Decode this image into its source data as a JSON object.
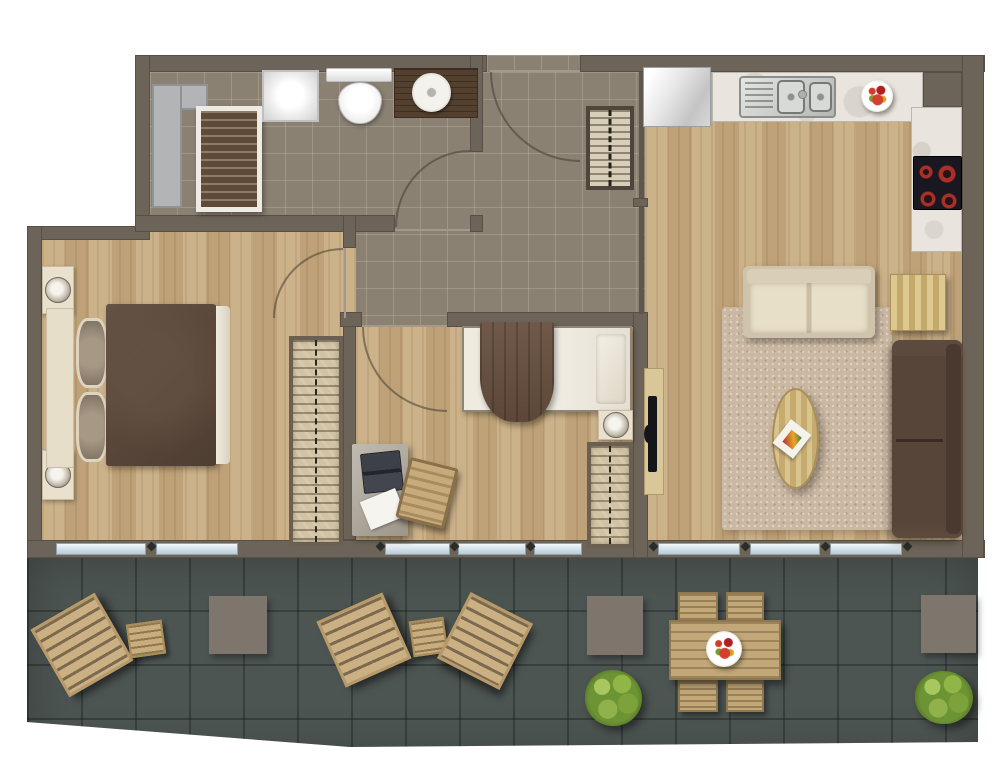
{
  "plan_type": "apartment-floor-plan-top-view",
  "rooms": [
    {
      "name": "bathroom",
      "floor": "grey-tile"
    },
    {
      "name": "entry-hall",
      "floor": "grey-tile"
    },
    {
      "name": "master-bedroom",
      "floor": "light-wood"
    },
    {
      "name": "bedroom-2",
      "floor": "light-wood"
    },
    {
      "name": "kitchen-living-room",
      "floor": "light-wood"
    },
    {
      "name": "terrace",
      "floor": "dark-slate-tile"
    }
  ],
  "palette": {
    "wall": "#6d6459",
    "hall_tile": "#8a8173",
    "wood_floor": "#c6aa80",
    "terrace_tile": "#4d5553",
    "rug": "#cbb8a2",
    "glass": "#d8e8f1",
    "sofa_cream": "#d9cfb8",
    "sofa_brown": "#57453a",
    "burner_red": "#a83028",
    "plant_green": "#6d9434"
  },
  "items": [
    {
      "kind": "duct",
      "name": "service-duct-vertical",
      "x": 152,
      "y": 84,
      "w": 30,
      "h": 124
    },
    {
      "kind": "duct",
      "name": "service-duct-top",
      "x": 180,
      "y": 84,
      "w": 28,
      "h": 26
    },
    {
      "kind": "cab-slats",
      "name": "bathroom-slatted-cabinet",
      "x": 196,
      "y": 106,
      "w": 66,
      "h": 106
    },
    {
      "kind": "shower",
      "name": "shower-tray",
      "x": 262,
      "y": 70,
      "w": 57,
      "h": 52
    },
    {
      "kind": "toilet-tank",
      "name": "toilet-cistern",
      "x": 326,
      "y": 68,
      "w": 66,
      "h": 14
    },
    {
      "kind": "toilet-bowl",
      "name": "toilet-bowl",
      "x": 338,
      "y": 82,
      "w": 44,
      "h": 42
    },
    {
      "kind": "vanity",
      "name": "bathroom-vanity",
      "x": 394,
      "y": 68,
      "w": 84,
      "h": 50
    },
    {
      "kind": "sink-round",
      "name": "bathroom-basin",
      "x": 412,
      "y": 73,
      "w": 39,
      "h": 39
    },
    {
      "kind": "closet",
      "name": "entry-closet",
      "x": 586,
      "y": 106,
      "w": 48,
      "h": 84
    },
    {
      "kind": "fridge",
      "name": "refrigerator",
      "x": 643,
      "y": 67,
      "w": 68,
      "h": 60
    },
    {
      "kind": "counter",
      "name": "kitchen-counter-top",
      "x": 712,
      "y": 72,
      "w": 211,
      "h": 50
    },
    {
      "kind": "counter",
      "name": "kitchen-counter-right",
      "x": 911,
      "y": 107,
      "w": 51,
      "h": 145
    },
    {
      "kind": "sink",
      "name": "kitchen-sink-unit",
      "x": 739,
      "y": 76,
      "w": 97,
      "h": 42
    },
    {
      "kind": "sinkboard",
      "name": "sink-drainboard",
      "x": 745,
      "y": 82,
      "w": 28,
      "h": 30
    },
    {
      "kind": "sinkbowl",
      "name": "sink-bowl-large",
      "x": 777,
      "y": 80,
      "w": 28,
      "h": 34
    },
    {
      "kind": "sinkbowl",
      "name": "sink-bowl-small",
      "x": 809,
      "y": 82,
      "w": 23,
      "h": 30
    },
    {
      "kind": "faucet",
      "name": "kitchen-faucet",
      "x": 798,
      "y": 90,
      "w": 9,
      "h": 9
    },
    {
      "kind": "bowl",
      "name": "fruit-bowl-kitchen",
      "x": 861,
      "y": 80,
      "w": 32,
      "h": 32
    },
    {
      "kind": "cooktop",
      "name": "cooktop-4-burners",
      "x": 913,
      "y": 156,
      "w": 49,
      "h": 54
    },
    {
      "kind": "rug",
      "name": "living-room-rug",
      "x": 722,
      "y": 307,
      "w": 170,
      "h": 223
    },
    {
      "kind": "tv-unit",
      "name": "tv-stand",
      "x": 644,
      "y": 368,
      "w": 20,
      "h": 127
    },
    {
      "kind": "tv",
      "name": "television",
      "x": 648,
      "y": 396,
      "w": 9,
      "h": 76
    },
    {
      "kind": "sofa-cream",
      "name": "sofa-two-seater",
      "x": 743,
      "y": 266,
      "w": 132,
      "h": 72
    },
    {
      "kind": "ottoman",
      "name": "striped-ottoman",
      "x": 890,
      "y": 274,
      "w": 56,
      "h": 57
    },
    {
      "kind": "sofa-brown",
      "name": "sofa-brown-chaise",
      "x": 892,
      "y": 340,
      "w": 71,
      "h": 198
    },
    {
      "kind": "coffee",
      "name": "coffee-table-oval",
      "x": 772,
      "y": 388,
      "w": 47,
      "h": 101
    },
    {
      "kind": "magazine",
      "name": "magazine",
      "x": 779,
      "y": 424,
      "w": 26,
      "h": 30,
      "rot": 38
    },
    {
      "kind": "nightstand",
      "name": "nightstand-master-top",
      "x": 42,
      "y": 266,
      "w": 32,
      "h": 48
    },
    {
      "kind": "nightstand",
      "name": "nightstand-master-bottom",
      "x": 42,
      "y": 450,
      "w": 32,
      "h": 50
    },
    {
      "kind": "headboard",
      "name": "double-bed-headboard",
      "x": 46,
      "y": 308,
      "w": 28,
      "h": 160
    },
    {
      "kind": "pillow",
      "name": "pillow-top",
      "x": 76,
      "y": 318,
      "w": 32,
      "h": 70
    },
    {
      "kind": "pillow",
      "name": "pillow-bottom",
      "x": 76,
      "y": 392,
      "w": 32,
      "h": 70
    },
    {
      "kind": "duvet",
      "name": "double-bed-duvet",
      "x": 106,
      "y": 304,
      "w": 112,
      "h": 162
    },
    {
      "kind": "sheet",
      "name": "double-bed-sheet-fold",
      "x": 216,
      "y": 306,
      "w": 14,
      "h": 158
    },
    {
      "kind": "wardrobe",
      "name": "wardrobe-master",
      "x": 289,
      "y": 336,
      "w": 54,
      "h": 210
    },
    {
      "kind": "mattress",
      "name": "single-bed-mattress",
      "x": 462,
      "y": 326,
      "w": 170,
      "h": 86
    },
    {
      "kind": "pillow2",
      "name": "single-bed-pillow",
      "x": 596,
      "y": 334,
      "w": 30,
      "h": 70
    },
    {
      "kind": "blanket",
      "name": "single-bed-blanket",
      "x": 480,
      "y": 322,
      "w": 74,
      "h": 100
    },
    {
      "kind": "nightstand",
      "name": "nightstand-bedroom2",
      "x": 598,
      "y": 410,
      "w": 35,
      "h": 30
    },
    {
      "kind": "wardrobe",
      "name": "wardrobe-bedroom2",
      "x": 587,
      "y": 442,
      "w": 46,
      "h": 106
    },
    {
      "kind": "desk",
      "name": "desk",
      "x": 352,
      "y": 444,
      "w": 56,
      "h": 92
    },
    {
      "kind": "laptop",
      "name": "laptop",
      "x": 362,
      "y": 452,
      "w": 40,
      "h": 40,
      "rot": -6
    },
    {
      "kind": "paper",
      "name": "paper-sheet",
      "x": 364,
      "y": 494,
      "w": 38,
      "h": 30,
      "rot": -22
    },
    {
      "kind": "chair-desk",
      "name": "desk-chair",
      "x": 402,
      "y": 462,
      "w": 50,
      "h": 62,
      "rot": 14
    },
    {
      "kind": "lounger",
      "name": "sun-lounger-1",
      "x": 45,
      "y": 606,
      "w": 74,
      "h": 78,
      "rot": -30
    },
    {
      "kind": "side-table",
      "name": "terrace-side-table-1",
      "x": 128,
      "y": 622,
      "w": 36,
      "h": 34,
      "rot": -8
    },
    {
      "kind": "mat",
      "name": "terrace-mat-1",
      "x": 209,
      "y": 596,
      "w": 58,
      "h": 58
    },
    {
      "kind": "lounger",
      "name": "sun-lounger-2",
      "x": 328,
      "y": 604,
      "w": 72,
      "h": 72,
      "rot": -24
    },
    {
      "kind": "side-table",
      "name": "terrace-side-table-2",
      "x": 411,
      "y": 619,
      "w": 35,
      "h": 36,
      "rot": -8
    },
    {
      "kind": "lounger",
      "name": "sun-lounger-3",
      "x": 450,
      "y": 604,
      "w": 70,
      "h": 74,
      "rot": 27
    },
    {
      "kind": "mat",
      "name": "terrace-mat-2",
      "x": 587,
      "y": 596,
      "w": 56,
      "h": 59
    },
    {
      "kind": "plant",
      "name": "terrace-plant-1",
      "x": 585,
      "y": 670,
      "w": 57,
      "h": 56
    },
    {
      "kind": "chair-out",
      "name": "dining-chair-1",
      "x": 678,
      "y": 592,
      "w": 40,
      "h": 30
    },
    {
      "kind": "chair-out",
      "name": "dining-chair-2",
      "x": 726,
      "y": 592,
      "w": 38,
      "h": 30
    },
    {
      "kind": "chair-out",
      "name": "dining-chair-3",
      "x": 678,
      "y": 680,
      "w": 40,
      "h": 32
    },
    {
      "kind": "chair-out",
      "name": "dining-chair-4",
      "x": 726,
      "y": 680,
      "w": 38,
      "h": 32
    },
    {
      "kind": "dining-table",
      "name": "terrace-dining-table",
      "x": 669,
      "y": 620,
      "w": 112,
      "h": 60
    },
    {
      "kind": "bowl",
      "name": "fruit-bowl-dining",
      "x": 706,
      "y": 631,
      "w": 36,
      "h": 36
    },
    {
      "kind": "mat",
      "name": "terrace-mat-3",
      "x": 921,
      "y": 595,
      "w": 55,
      "h": 58
    },
    {
      "kind": "plant",
      "name": "terrace-plant-2",
      "x": 915,
      "y": 671,
      "w": 58,
      "h": 53
    }
  ]
}
